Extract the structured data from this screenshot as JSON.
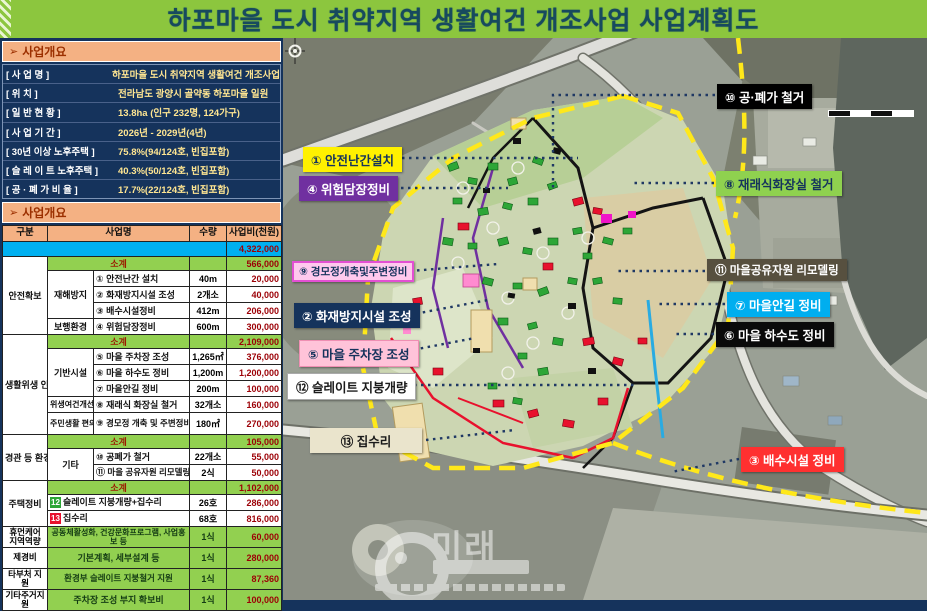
{
  "title": "하포마을 도시 취약지역 생활여건 개조사업 사업계획도",
  "colors": {
    "title_bg": "#8CC63E",
    "panel_bg": "#15335C",
    "section_bg": "#F4B183",
    "section_text": "#9c3000",
    "total_row": "#00B0F0",
    "green_row": "#92D050",
    "amount_text": "#9c0006",
    "boundary_yellow": "#FFE81A",
    "leader_navy": "#1F3864"
  },
  "overview": {
    "section_title": "사업개요",
    "rows": [
      {
        "label": "[ 사      업      명 ]",
        "value": "하포마을 도시 취약지역 생활여건 개조사업"
      },
      {
        "label": "[ 위                 치 ]",
        "value": "전라남도 광양시 골약동 하포마을 일원"
      },
      {
        "label": "[ 일   반   현   황 ]",
        "value": "13.8ha (인구 232명, 124가구)"
      },
      {
        "label": "[ 사   업   기   간 ]",
        "value": "2026년 - 2029년(4년)"
      },
      {
        "label": "[ 30년 이상  노후주택 ]",
        "value": "75.8%(94/124호, 빈집포함)"
      },
      {
        "label": "[ 슬 레 이 트  노후주택 ]",
        "value": "40.3%(50/124호, 빈집포함)"
      },
      {
        "label": "[ 공 · 폐 가   비  율 ]",
        "value": "17.7%(22/124호, 빈집포함)"
      }
    ]
  },
  "budget": {
    "section_title": "사업개요",
    "col_headers": [
      "구분",
      "사업명",
      "수량",
      "사업비(천원)"
    ],
    "total_amount": "4,322,000",
    "subtotal_label": "소계",
    "subtotals": [
      "566,000",
      "2,109,000",
      "105,000",
      "1,102,000"
    ],
    "groups": [
      "안전확보",
      "생활위생\n인프라",
      "경관 등\n환경개선",
      "주택정비"
    ],
    "subcats": [
      "재해방지",
      "보행환경",
      "기반시설",
      "위생여건개선",
      "주민생활\n편의시설",
      "기타"
    ],
    "items": [
      {
        "num": "①",
        "name": "안전난간 설치",
        "qty": "40m",
        "amount": "20,000"
      },
      {
        "num": "②",
        "name": "화재방지시설 조성",
        "qty": "2개소",
        "amount": "40,000"
      },
      {
        "num": "③",
        "name": "배수시설정비",
        "qty": "412m",
        "amount": "206,000"
      },
      {
        "num": "④",
        "name": "위험담장정비",
        "qty": "600m",
        "amount": "300,000"
      },
      {
        "num": "⑤",
        "name": "마을 주차장 조성",
        "qty": "1,265㎡",
        "amount": "376,000"
      },
      {
        "num": "⑥",
        "name": "마을 하수도 정비",
        "qty": "1,200m",
        "amount": "1,200,000"
      },
      {
        "num": "⑦",
        "name": "마을안길 정비",
        "qty": "200m",
        "amount": "100,000"
      },
      {
        "num": "⑧",
        "name": "재래식 화장실 철거",
        "qty": "32개소",
        "amount": "160,000"
      },
      {
        "num": "⑨",
        "name": "경모정 개축 및 주변정비",
        "qty": "180㎡",
        "amount": "270,000"
      },
      {
        "num": "⑩",
        "name": "공폐가 철거",
        "qty": "22개소",
        "amount": "55,000"
      },
      {
        "num": "⑪",
        "name": "마을 공유자원 리모델링",
        "qty": "2식",
        "amount": "50,000"
      },
      {
        "num": "12",
        "name": "슬레이트 지붕개량+집수리",
        "qty": "26호",
        "amount": "286,000"
      },
      {
        "num": "13",
        "name": "집수리",
        "qty": "68호",
        "amount": "816,000"
      }
    ],
    "extra_rows": [
      {
        "group": "휴먼케어\n지역역량",
        "name": "공동체활성화, 건강문화프로그램, 사업홍보 등",
        "qty": "1식",
        "amount": "60,000"
      },
      {
        "group": "제경비",
        "name": "기본계획, 세부설계 등",
        "qty": "1식",
        "amount": "280,000"
      },
      {
        "group": "타부처 지원",
        "name": "환경부 슬레이트 지붕철거 지원",
        "qty": "1식",
        "amount": "87,360"
      },
      {
        "group": "기타주거지원",
        "name": "주차장 조성 부지 확보비",
        "qty": "1식",
        "amount": "100,000"
      }
    ]
  },
  "map": {
    "labels": [
      {
        "id": "safety-railing",
        "text": "① 안전난간설치"
      },
      {
        "id": "dangerous-wall",
        "text": "④ 위험담장정비"
      },
      {
        "id": "senior-hall",
        "text": "⑨ 경모정개축및주변정비"
      },
      {
        "id": "fire-prevention",
        "text": "② 화재방지시설 조성"
      },
      {
        "id": "village-parking",
        "text": "⑤ 마을 주차장 조성"
      },
      {
        "id": "slate-roof",
        "text": "⑫ 슬레이트 지붕개량"
      },
      {
        "id": "house-repair",
        "text": "⑬ 집수리"
      },
      {
        "id": "vacant-house-demolition",
        "text": "⑩ 공·폐가 철거"
      },
      {
        "id": "toilet-demolition",
        "text": "⑧ 재래식화장실 철거"
      },
      {
        "id": "shared-resource-remodel",
        "text": "⑪ 마을공유자원 리모델링"
      },
      {
        "id": "village-road",
        "text": "⑦ 마을안길 정비"
      },
      {
        "id": "sewer",
        "text": "⑥ 마을 하수도 정비"
      },
      {
        "id": "drainage",
        "text": "③ 배수시설 정비"
      }
    ],
    "watermark": "미래"
  }
}
